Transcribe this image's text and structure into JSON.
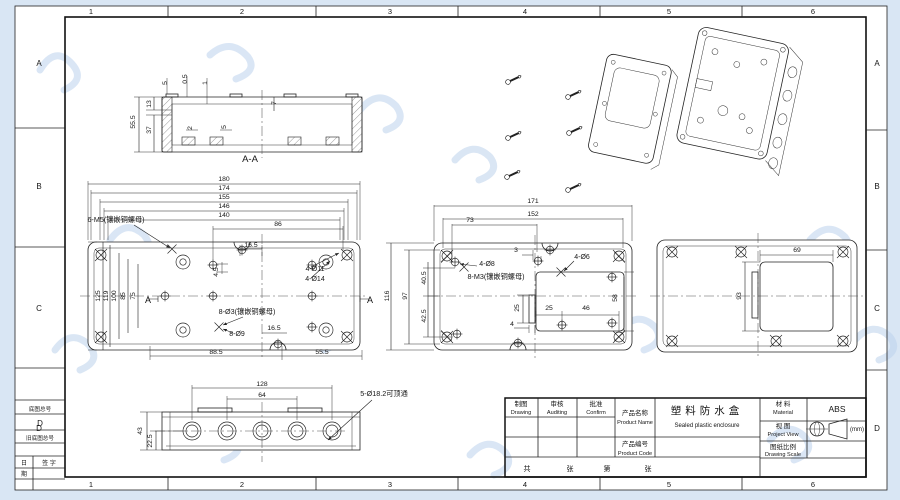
{
  "colors": {
    "line": "#222222",
    "sheet": "#ffffff",
    "background": "#d9e6f4",
    "watermark": "#bcd2ec"
  },
  "sheet": {
    "columns": [
      "1",
      "2",
      "3",
      "4",
      "5",
      "6"
    ],
    "column_xs": [
      91,
      242,
      390,
      525,
      669,
      813
    ],
    "column_y_top": 14,
    "column_y_bottom": 487,
    "rows": [
      "A",
      "B",
      "C",
      "D"
    ],
    "row_ys": [
      66,
      189,
      311,
      431
    ],
    "row_x_left": 39,
    "row_x_right": 877
  },
  "margin_block": {
    "archive_label": "底图总号",
    "archive_value": "D",
    "old_archive_label": "旧底图总号",
    "day_label": "日",
    "period_label": "期",
    "sign_label": "签 字"
  },
  "title_block": {
    "drafter_cn": "制图",
    "drafter_en": "Drawing",
    "auditor_cn": "审核",
    "auditor_en": "Auditing",
    "approver_cn": "批准",
    "approver_en": "Confirm",
    "product_name_cn": "产品名称",
    "product_name_en": "Product Name",
    "product_name_value_cn": "塑料防水盒",
    "product_name_value_en": "Sealed plastic enclosure",
    "product_code_cn": "产品编号",
    "product_code_en": "Product Code",
    "material_cn": "材 料",
    "material_en": "Material",
    "material_value": "ABS",
    "view_cn": "视 图",
    "view_en": "Project View",
    "unit": "(mm)",
    "scale_cn": "图纸比例",
    "scale_en": "Drawing Scale",
    "footer_total": "共",
    "footer_sheet": "张",
    "footer_number": "第",
    "footer_sheet2": "张"
  },
  "views": {
    "section": {
      "labels": [
        {
          "t": "5",
          "x": 167,
          "y": 83,
          "r": -90
        },
        {
          "t": "0.5",
          "x": 187,
          "y": 79,
          "r": -90
        },
        {
          "t": "1",
          "x": 207,
          "y": 83,
          "r": -90
        },
        {
          "t": "7",
          "x": 276,
          "y": 103,
          "r": -90
        },
        {
          "t": "55.5",
          "x": 135,
          "y": 122,
          "r": -90
        },
        {
          "t": "13",
          "x": 151,
          "y": 104,
          "r": -90
        },
        {
          "t": "37",
          "x": 151,
          "y": 130,
          "r": -90
        },
        {
          "t": "2",
          "x": 192,
          "y": 128,
          "r": -90
        },
        {
          "t": "5",
          "x": 226,
          "y": 127,
          "r": -90
        },
        {
          "n": "section-title",
          "t": "A-A",
          "x": 250,
          "y": 162,
          "s": 9.5
        }
      ]
    },
    "front": {
      "labels": [
        {
          "t": "180",
          "x": 224,
          "y": 181
        },
        {
          "t": "174",
          "x": 224,
          "y": 190
        },
        {
          "t": "155",
          "x": 224,
          "y": 199
        },
        {
          "t": "146",
          "x": 224,
          "y": 208
        },
        {
          "t": "140",
          "x": 224,
          "y": 217
        },
        {
          "t": "86",
          "x": 278,
          "y": 226
        },
        {
          "t": "16.5",
          "x": 251,
          "y": 247
        },
        {
          "n": "note-insert-m5",
          "t": "6-M5(镶嵌铜螺母)",
          "x": 116,
          "y": 222,
          "s": 7.2
        },
        {
          "t": "4-Ø11",
          "x": 315,
          "y": 271,
          "s": 7
        },
        {
          "t": "4-Ø14",
          "x": 315,
          "y": 281,
          "s": 7
        },
        {
          "t": "125",
          "x": 100,
          "y": 296,
          "r": -90
        },
        {
          "t": "119",
          "x": 108,
          "y": 296,
          "r": -90
        },
        {
          "t": "100",
          "x": 116,
          "y": 296,
          "r": -90
        },
        {
          "t": "85",
          "x": 125,
          "y": 296,
          "r": -90
        },
        {
          "t": "75",
          "x": 135,
          "y": 296,
          "r": -90
        },
        {
          "t": "4.5",
          "x": 218,
          "y": 272,
          "r": -90
        },
        {
          "n": "section-arrow-label",
          "t": "A",
          "x": 148,
          "y": 303,
          "s": 9
        },
        {
          "n": "section-arrow-label",
          "t": "A",
          "x": 370,
          "y": 303,
          "s": 9
        },
        {
          "n": "note-insert-m3",
          "t": "8-Ø3(镶嵌铜螺母)",
          "x": 247,
          "y": 314,
          "s": 7.2
        },
        {
          "t": "8-Ø9",
          "x": 237,
          "y": 336,
          "s": 7
        },
        {
          "t": "16.5",
          "x": 274,
          "y": 330
        },
        {
          "t": "88.5",
          "x": 216,
          "y": 354
        },
        {
          "t": "55.5",
          "x": 322,
          "y": 354
        }
      ]
    },
    "mid": {
      "labels": [
        {
          "t": "171",
          "x": 533,
          "y": 203
        },
        {
          "t": "152",
          "x": 533,
          "y": 216
        },
        {
          "t": "73",
          "x": 470,
          "y": 222
        },
        {
          "t": "3",
          "x": 516,
          "y": 252
        },
        {
          "t": "4-Ø8",
          "x": 487,
          "y": 266,
          "s": 7
        },
        {
          "n": "note-insert-m3-mid",
          "t": "8-M3(镶嵌铜螺母)",
          "x": 496,
          "y": 279,
          "s": 7.2
        },
        {
          "t": "4-Ø6",
          "x": 582,
          "y": 259,
          "s": 7
        },
        {
          "t": "58",
          "x": 617,
          "y": 298,
          "r": -90
        },
        {
          "t": "25",
          "x": 519,
          "y": 308,
          "r": -90
        },
        {
          "t": "4",
          "x": 512,
          "y": 326
        },
        {
          "t": "25",
          "x": 549,
          "y": 310
        },
        {
          "t": "46",
          "x": 586,
          "y": 310
        },
        {
          "t": "116",
          "x": 389,
          "y": 296,
          "r": -90
        },
        {
          "t": "97",
          "x": 407,
          "y": 296,
          "r": -90
        },
        {
          "t": "40.5",
          "x": 426,
          "y": 278,
          "r": -90
        },
        {
          "t": "42.5",
          "x": 426,
          "y": 316,
          "r": -90
        }
      ]
    },
    "right": {
      "labels": [
        {
          "t": "69",
          "x": 797,
          "y": 252
        },
        {
          "t": "93",
          "x": 741,
          "y": 296,
          "r": -90
        }
      ]
    },
    "bottom": {
      "labels": [
        {
          "t": "128",
          "x": 262,
          "y": 386
        },
        {
          "t": "64",
          "x": 262,
          "y": 397
        },
        {
          "n": "note-knockout",
          "t": "5-Ø18.2可顶通",
          "x": 384,
          "y": 396,
          "s": 7.2
        },
        {
          "t": "43",
          "x": 142,
          "y": 431,
          "r": -90
        },
        {
          "t": "22.5",
          "x": 152,
          "y": 441,
          "r": -90
        }
      ]
    }
  }
}
